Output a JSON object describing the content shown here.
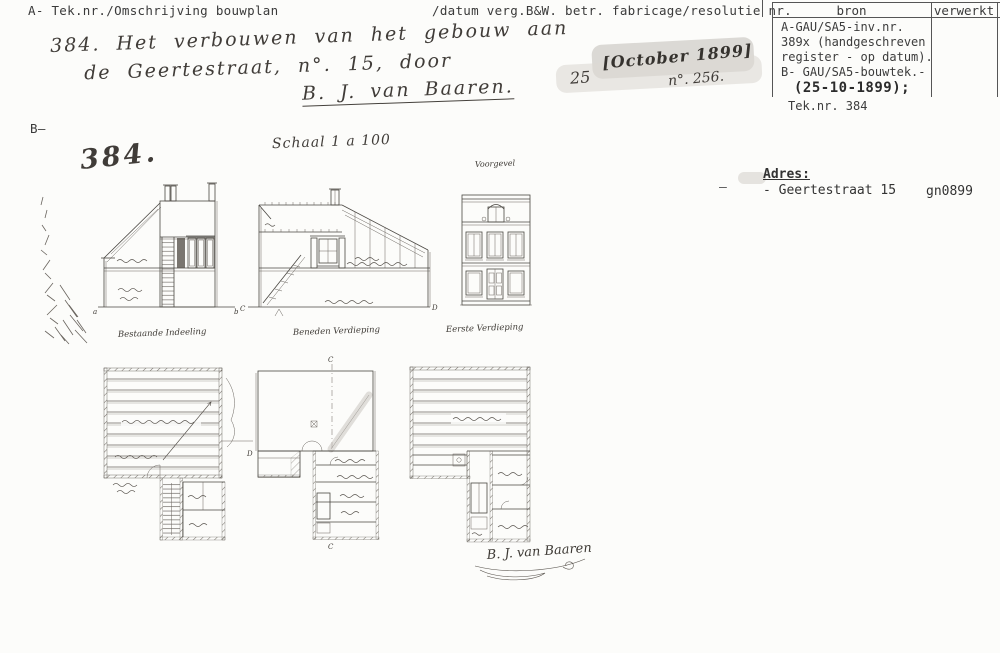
{
  "document": {
    "header": {
      "left": "A- Tek.nr./Omschrijving bouwplan",
      "right": "/datum verg.B&W. betr. fabricage/resolutie nr."
    },
    "bron_table": {
      "header_bron": "bron",
      "header_verwerkt": "verwerkt",
      "source_lines": [
        "A-GAU/SA5-inv.nr.",
        "389x (handgeschreven",
        "register - op datum).",
        "B- GAU/SA5-bouwtek.-"
      ],
      "date": "(25-10-1899);",
      "teknr": "Tek.nr. 384"
    },
    "entry": {
      "description_line1": "384. Het verbouwen van het gebouw aan",
      "description_line2": "de Geertestraat, n°. 15, door",
      "builder": "B. J. van Baaren.",
      "day": "25",
      "month_stamp": "[October 1899]",
      "resolutie_nr": "n°. 256."
    },
    "section_b": {
      "marker": "B—",
      "sheet_number": "384.",
      "scale_note": "Schaal 1 a 100"
    },
    "adres": {
      "dash": "—",
      "label": "Adres:",
      "street": "- Geertestraat 15",
      "code": "gn0899"
    },
    "drawing_labels": {
      "voorgevel": "Voorgevel",
      "plan_existing": "Bestaande Indeeling",
      "plan_ground": "Beneden Verdieping",
      "plan_first": "Eerste Verdieping",
      "mark_a": "a",
      "mark_b": "b",
      "mark_c_top": "C",
      "mark_c_left": "C",
      "mark_c_bottom": "C",
      "mark_d": "D",
      "mark_d_plan": "D",
      "signature": "B. J. van Baaren"
    },
    "colors": {
      "ink": "#4a4742",
      "paper": "#fcfcfa",
      "smudge": "#d2cfca"
    }
  }
}
